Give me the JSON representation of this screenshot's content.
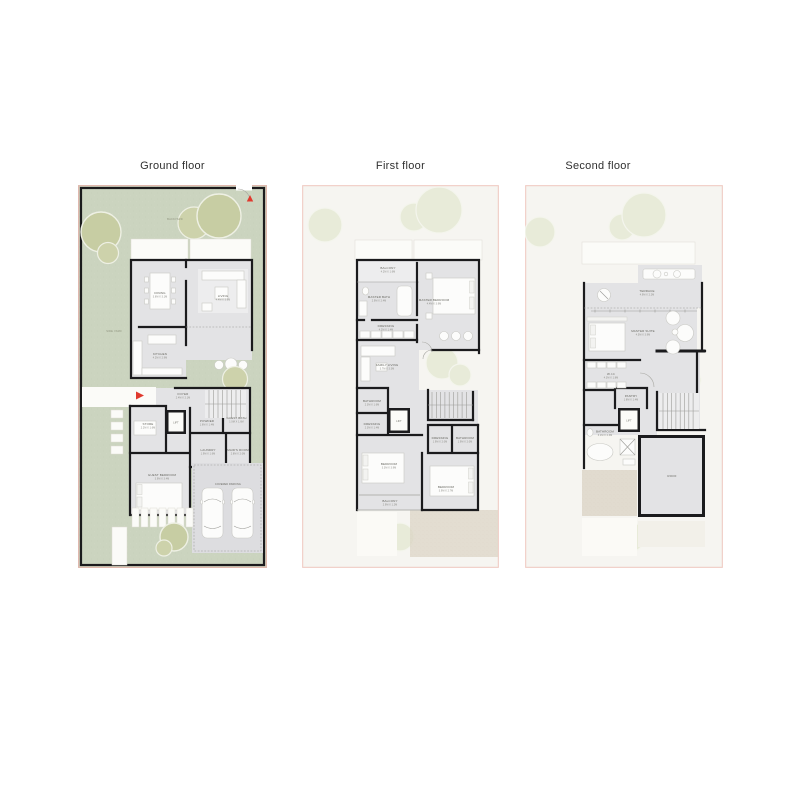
{
  "titles": {
    "ground": "Ground floor",
    "first": "First floor",
    "second": "Second floor"
  },
  "colors": {
    "garden": "#cbd4bf",
    "tree": "#c7cda3",
    "wall": "#1b1b1d",
    "floor": "#e3e3e5",
    "page_bg": "#f6f5f0",
    "page_border": "#f0c8c0",
    "paving": "#dcd5c6",
    "marker_red": "#e0392e"
  },
  "plans": {
    "ground": {
      "backyard": "BACKYARD",
      "sideyard": "SIDE YARD",
      "dining": {
        "name": "DINING",
        "dims": "3.6M X 3.1M"
      },
      "living": {
        "name": "LIVING",
        "dims": "4.4M X 3.9M"
      },
      "kitchen": {
        "name": "KITCHEN",
        "dims": "4.2M X 2.9M"
      },
      "foyer": {
        "name": "FOYER",
        "dims": "2.4M X 2.1M"
      },
      "lift": "LIFT",
      "store": {
        "name": "STORE",
        "dims": "2.2M X 1.6M"
      },
      "powder": {
        "name": "POWDER",
        "dims": "1.6M X 1.4M"
      },
      "guest_bath": {
        "name": "GUEST BATH",
        "dims": "1.9M X 1.6M"
      },
      "laundry": {
        "name": "LAUNDRY",
        "dims": "1.9M X 1.6M"
      },
      "maids_room": {
        "name": "MAID'S ROOM",
        "dims": "2.8M X 2.0M"
      },
      "guest_bedroom": {
        "name": "GUEST BEDROOM",
        "dims": "3.9M X 3.4M"
      },
      "parking": "COVERED PARKING"
    },
    "first": {
      "balcony": {
        "name": "BALCONY",
        "dims": "4.2M X 1.6M"
      },
      "master_bath": {
        "name": "MASTER BATH",
        "dims": "2.9M X 2.4M"
      },
      "master_bedroom": {
        "name": "MASTER BEDROOM",
        "dims": "4.4M X 3.9M"
      },
      "dressing": {
        "name": "DRESSING",
        "dims": "4.2M X 1.4M"
      },
      "family_living": {
        "name": "FAMILY LIVING",
        "dims": "3.7M X 3.3M"
      },
      "bathroom": {
        "name": "BATHROOM",
        "dims": "2.3M X 1.6M"
      },
      "dressing2": {
        "name": "DRESSING",
        "dims": "2.3M X 1.4M"
      },
      "lift": "LIFT",
      "dressing3": {
        "name": "DRESSING",
        "dims": "1.9M X 2.0M"
      },
      "bathroom2": {
        "name": "BATHROOM",
        "dims": "1.9M X 2.0M"
      },
      "bedroom1": {
        "name": "BEDROOM",
        "dims": "3.3M X 3.9M"
      },
      "balcony2": {
        "name": "BALCONY",
        "dims": "2.9M X 1.2M"
      },
      "bedroom2": {
        "name": "BEDROOM",
        "dims": "3.9M X 2.7M"
      }
    },
    "second": {
      "terrace": {
        "name": "TERRACE",
        "dims": "4.9M X 2.2M"
      },
      "master_suite": {
        "name": "MASTER SUITE",
        "dims": "4.5M X 3.9M"
      },
      "wic": {
        "name": "W.I.C",
        "dims": "4.3M X 1.8M"
      },
      "pantry": {
        "name": "PANTRY",
        "dims": "1.8M X 1.4M"
      },
      "lift": "LIFT",
      "bathroom": {
        "name": "BATHROOM",
        "dims": "3.1M X 2.3M"
      },
      "roof": "ROOF"
    }
  }
}
